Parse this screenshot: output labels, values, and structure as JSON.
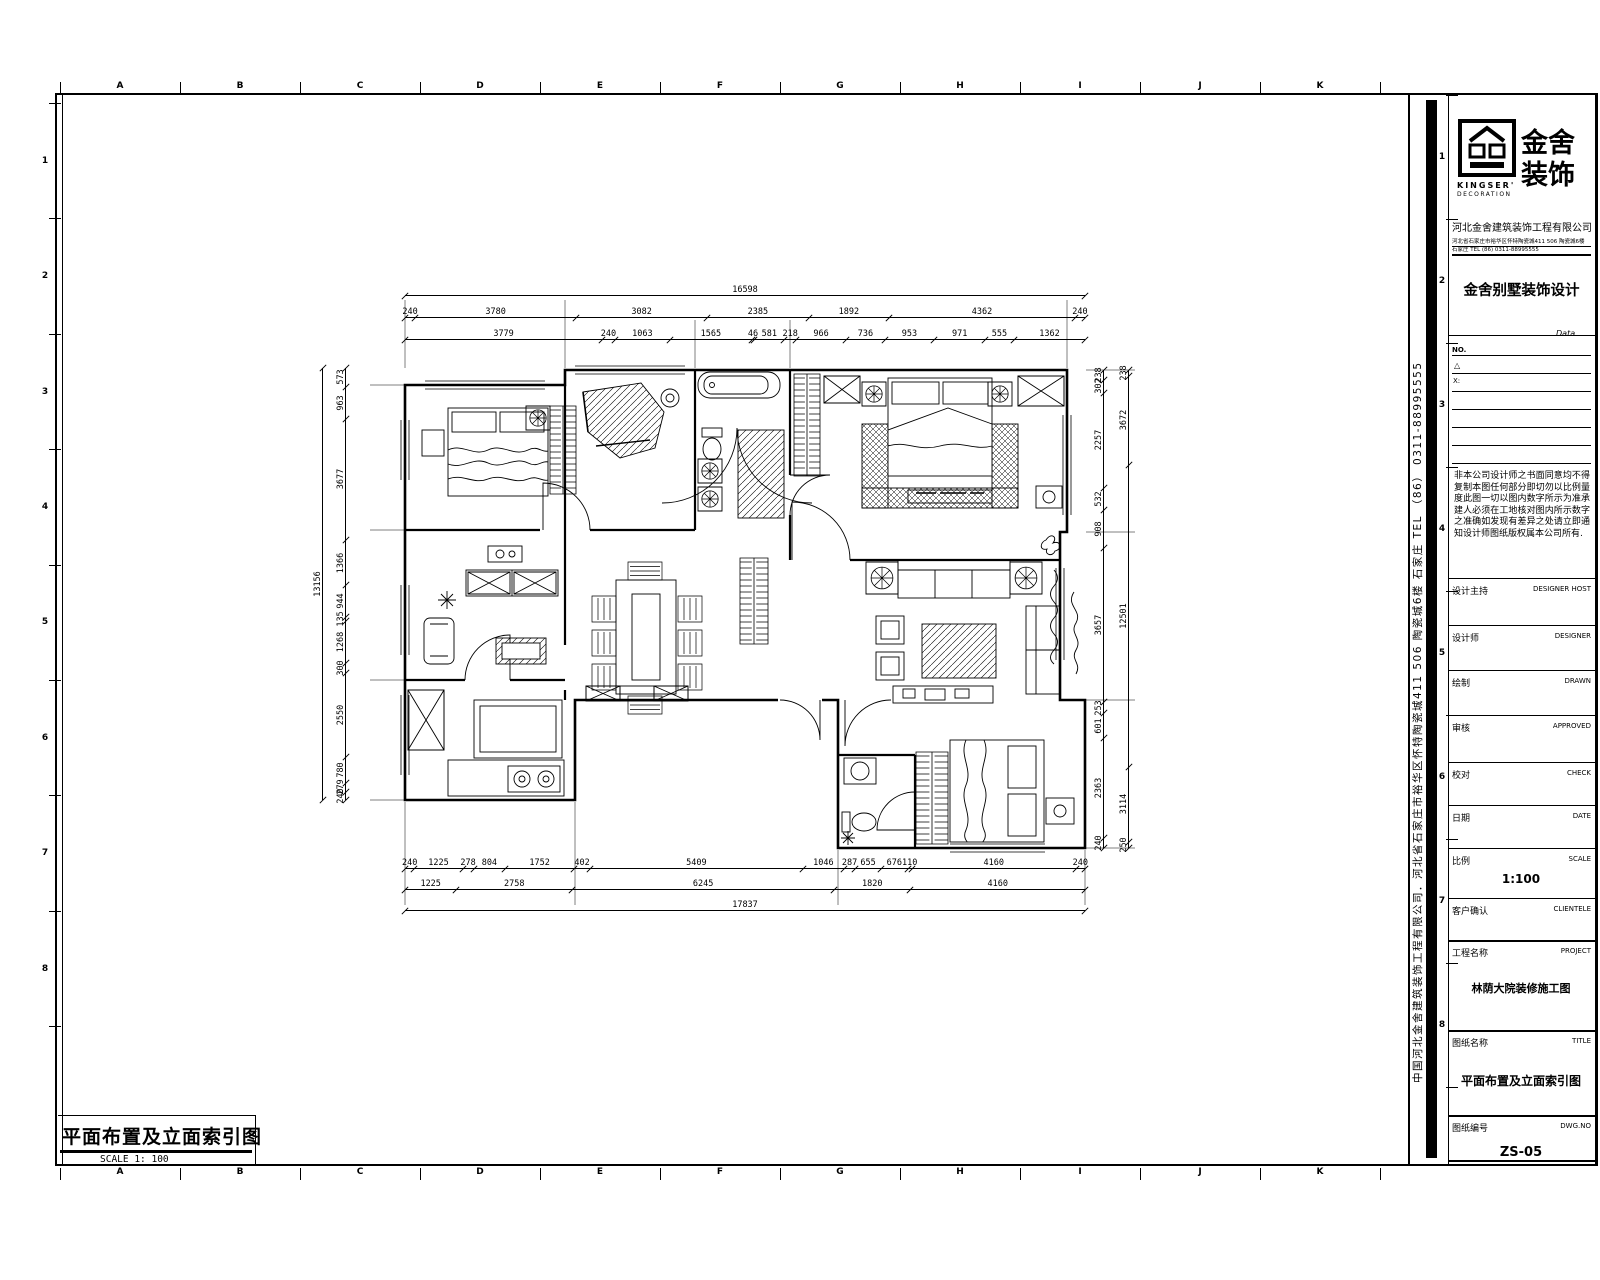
{
  "sheet": {
    "grid_letters": [
      "A",
      "B",
      "C",
      "D",
      "E",
      "F",
      "G",
      "H",
      "I",
      "J",
      "K"
    ],
    "row_numbers": [
      "1",
      "2",
      "3",
      "4",
      "5",
      "6",
      "7",
      "8"
    ],
    "titleblock_row_numbers": [
      "1",
      "2",
      "3",
      "4",
      "5",
      "6",
      "7",
      "8"
    ],
    "bottom_title": "平面布置及立面索引图",
    "bottom_scale": "SCALE 1: 100"
  },
  "title_block": {
    "logo": {
      "cn_line1": "金舍",
      "cn_line2": "装饰",
      "en_line1": "KINGSER'",
      "en_line2": "DECORATION"
    },
    "company_name": "河北金舍建筑装饰工程有限公司",
    "company_address_small": "河北省石家庄市裕华区怀特陶瓷城411 506 陶瓷城6楼",
    "company_contact_small": "石家庄 TEL (86) 0311-88995555",
    "section_title": "金舍别墅装饰设计",
    "data_label": "Data",
    "rev_no_label": "NO.",
    "rev_tri_label": "△",
    "rev_x_label": "X:",
    "disclaimer": "非本公司设计师之书面同意均不得复制本图任何部分即切勿以比例量度此图一切以图内数字所示为准承建人必须在工地核对图内所示数字之准确如发现有差异之处请立即通知设计师图纸版权属本公司所有.",
    "fields": [
      {
        "cn": "设计主持",
        "en": "DESIGNER HOST",
        "value": ""
      },
      {
        "cn": "设计师",
        "en": "DESIGNER",
        "value": ""
      },
      {
        "cn": "绘制",
        "en": "DRAWN",
        "value": ""
      },
      {
        "cn": "审核",
        "en": "APPROVED",
        "value": ""
      },
      {
        "cn": "校对",
        "en": "CHECK",
        "value": ""
      },
      {
        "cn": "日期",
        "en": "DATE",
        "value": ""
      },
      {
        "cn": "比例",
        "en": "SCALE",
        "value": "1:100"
      },
      {
        "cn": "客户确认",
        "en": "CLIENTELE",
        "value": ""
      },
      {
        "cn": "工程名称",
        "en": "PROJECT",
        "value": "林荫大院装修施工图"
      },
      {
        "cn": "图纸名称",
        "en": "TITLE",
        "value": "平面布置及立面索引图"
      },
      {
        "cn": "图纸编号",
        "en": "DWG.NO",
        "value": "ZS-05"
      }
    ],
    "side_text": "中国河北金舍建筑装饰工程有限公司．河北省石家庄市裕华区怀特陶瓷城411 506 陶瓷城6楼  石家庄  TEL （86） 0311-88995555"
  },
  "dimensions": {
    "top_total": [
      "16598"
    ],
    "top_row1": [
      "240",
      "3780",
      "3082",
      "2385",
      "1892",
      "4362",
      "240"
    ],
    "top_row2": [
      "3779",
      "240",
      "1063",
      "1565",
      "46",
      "581",
      "218",
      "966",
      "736",
      "953",
      "971",
      "555",
      "1362"
    ],
    "left_col": [
      "573",
      "963",
      "3677",
      "1366",
      "944",
      "135",
      "1268",
      "300",
      "2550",
      "780",
      "279",
      "240"
    ],
    "left_total": [
      "13156"
    ],
    "right_col1": [
      "238",
      "302",
      "2257",
      "532",
      "908",
      "3657",
      "253",
      "601",
      "2363",
      "240"
    ],
    "right_col2": [
      "238",
      "3672",
      "12501",
      "3114",
      "250"
    ],
    "bottom_row1": [
      "240",
      "1225",
      "278",
      "804",
      "1752",
      "402",
      "5409",
      "1046",
      "287",
      "655",
      "676",
      "110",
      "4160",
      "240"
    ],
    "bottom_row2": [
      "1225",
      "2758",
      "6245",
      "1820",
      "4160"
    ],
    "bottom_total": [
      "17837"
    ]
  }
}
